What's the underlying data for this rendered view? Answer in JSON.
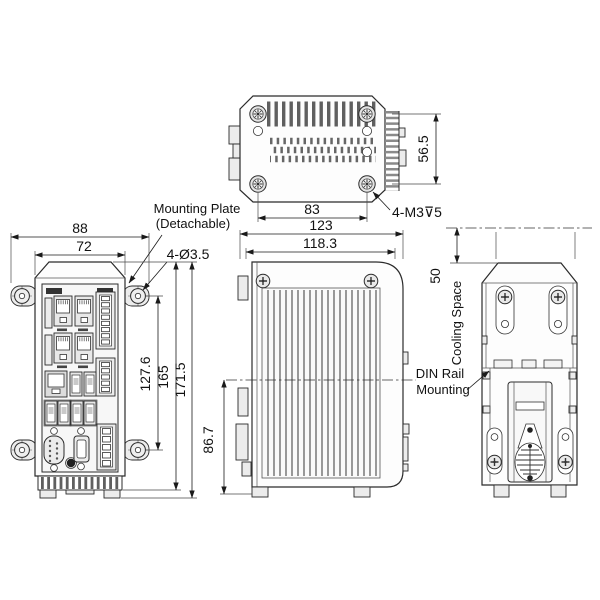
{
  "annotations": {
    "mounting_plate_line1": "Mounting Plate",
    "mounting_plate_line2": "(Detachable)",
    "front_mount_holes": "4-Ø3.5",
    "top_mount_screws": "4-M3⊽5",
    "cooling_space": "Cooling Space",
    "din_rail_line1": "DIN Rail",
    "din_rail_line2": "Mounting"
  },
  "dimensions": {
    "front_outer_width": "88",
    "front_body_width": "72",
    "front_hole_pitch": "127.6",
    "front_body_height": "165",
    "front_overall_height": "171.5",
    "top_screw_span": "83",
    "top_screw_depth_span": "56.5",
    "side_overall_depth": "123",
    "side_body_depth": "118.3",
    "side_lower_height": "86.7",
    "rear_cooling_clearance": "50"
  }
}
